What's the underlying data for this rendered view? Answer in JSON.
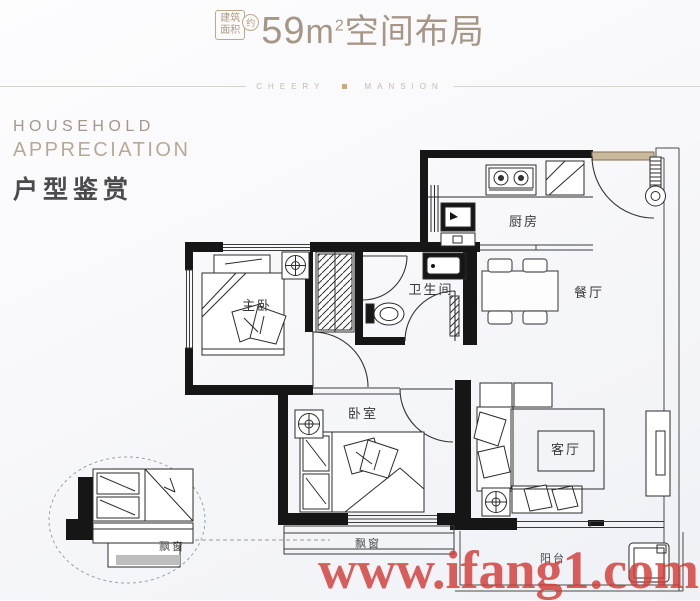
{
  "header": {
    "badge": {
      "line1": "建筑",
      "line2": "面积",
      "approx": "约"
    },
    "area_number": "59",
    "area_unit": "m",
    "area_superscript": "2",
    "title": "空间布局"
  },
  "brand_divider": {
    "left": "CHEERY",
    "right": "MANSION"
  },
  "sidebar": {
    "english_line1": "HOUSEHOLD",
    "english_line2": "APPRECIATION",
    "chinese_title": "户型鉴赏"
  },
  "floorplan": {
    "labels": {
      "kitchen": "厨房",
      "dining": "餐厅",
      "bathroom": "卫生间",
      "master_bedroom": "主卧",
      "bedroom": "卧室",
      "living_room": "客厅",
      "bay_window": "飘窗",
      "balcony": "阳台",
      "detail_bay_window": "飘窗"
    }
  },
  "watermark": {
    "text": "www.ifang1.com",
    "color": "#d23c38"
  },
  "colors": {
    "accent_tan": "#a69686",
    "wall": "#161616"
  }
}
